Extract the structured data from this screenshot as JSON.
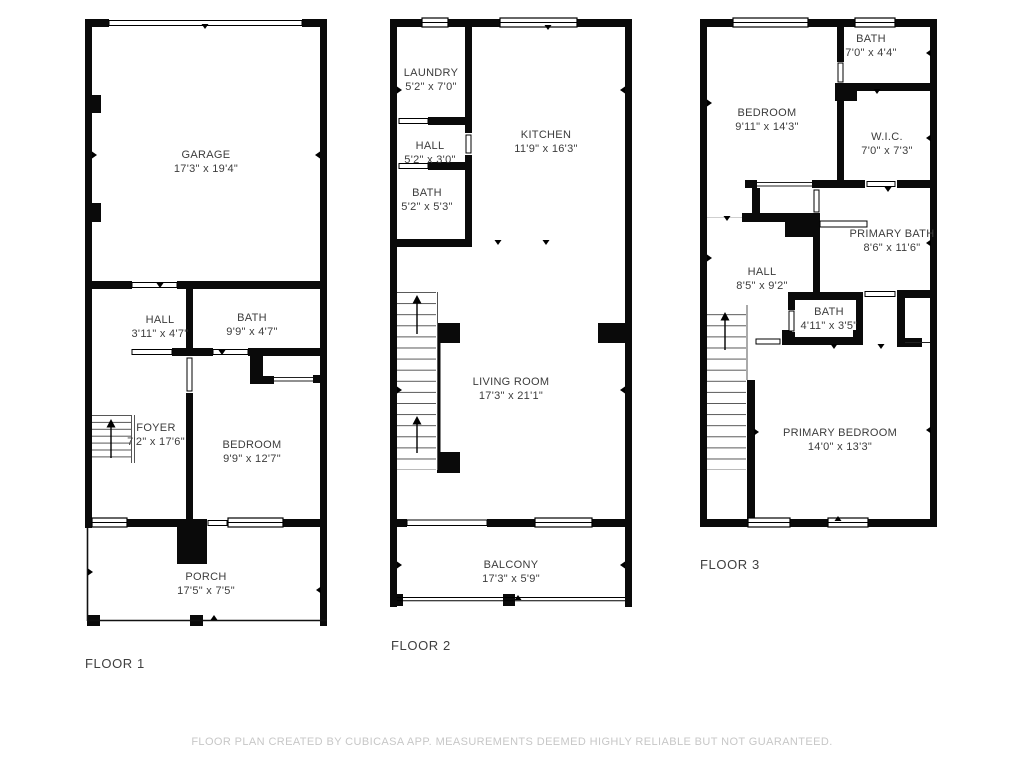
{
  "colors": {
    "background": "#ffffff",
    "walls": "#0a0a0a",
    "room_label_text": "#3c3c3c",
    "floor_label_text": "#3f3f3f",
    "footer_text": "#c7c7c7"
  },
  "floors": [
    {
      "label": "FLOOR 1",
      "rooms": [
        {
          "name": "GARAGE",
          "dims": "17'3\" x 19'4\""
        },
        {
          "name": "HALL",
          "dims": "3'11\" x 4'7\""
        },
        {
          "name": "BATH",
          "dims": "9'9\" x 4'7\""
        },
        {
          "name": "FOYER",
          "dims": "7'2\" x 17'6\""
        },
        {
          "name": "BEDROOM",
          "dims": "9'9\" x 12'7\""
        },
        {
          "name": "PORCH",
          "dims": "17'5\" x 7'5\""
        }
      ]
    },
    {
      "label": "FLOOR 2",
      "rooms": [
        {
          "name": "LAUNDRY",
          "dims": "5'2\" x 7'0\""
        },
        {
          "name": "HALL",
          "dims": "5'2\" x 3'0\""
        },
        {
          "name": "BATH",
          "dims": "5'2\" x 5'3\""
        },
        {
          "name": "KITCHEN",
          "dims": "11'9\" x 16'3\""
        },
        {
          "name": "LIVING ROOM",
          "dims": "17'3\" x 21'1\""
        },
        {
          "name": "BALCONY",
          "dims": "17'3\" x 5'9\""
        }
      ]
    },
    {
      "label": "FLOOR 3",
      "rooms": [
        {
          "name": "BATH",
          "dims": "7'0\" x 4'4\""
        },
        {
          "name": "BEDROOM",
          "dims": "9'11\" x 14'3\""
        },
        {
          "name": "W.I.C.",
          "dims": "7'0\" x 7'3\""
        },
        {
          "name": "PRIMARY BATH",
          "dims": "8'6\" x 11'6\""
        },
        {
          "name": "HALL",
          "dims": "8'5\" x 9'2\""
        },
        {
          "name": "BATH",
          "dims": "4'11\" x 3'5\""
        },
        {
          "name": "PRIMARY BEDROOM",
          "dims": "14'0\" x 13'3\""
        }
      ]
    }
  ],
  "footer": "FLOOR PLAN CREATED BY CUBICASA APP. MEASUREMENTS DEEMED HIGHLY RELIABLE BUT NOT GUARANTEED."
}
